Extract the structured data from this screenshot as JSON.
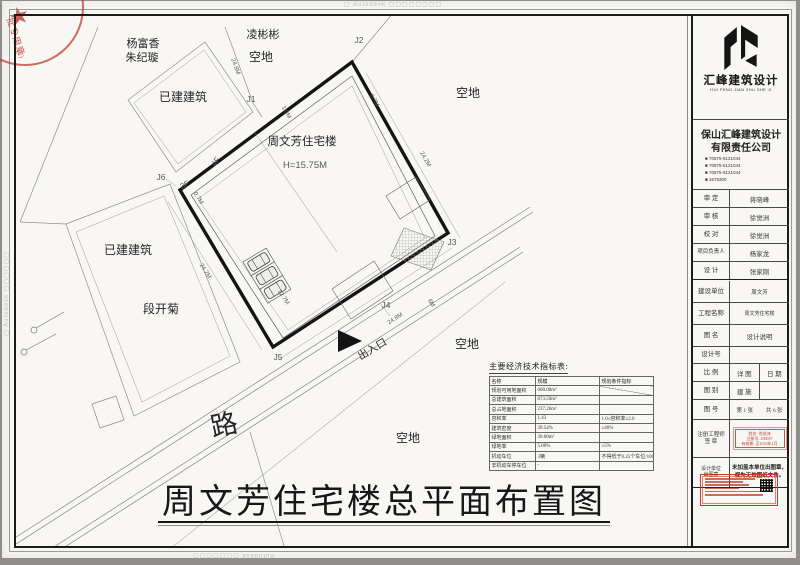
{
  "watermarks": {
    "top": "▢ Autodesk ▢▢▢▢▢▢▢▢",
    "left": "▢ Autodesk ▢▢▢▢▢▢",
    "right": "▢ Autodesk ▢▢▢▢▢▢",
    "bottom": "Autodesk ▢▢▢▢▢▢▢"
  },
  "corner_stamp": {
    "star": "★",
    "line1": "批专用章",
    "line2": "(2)"
  },
  "plan": {
    "labels": {
      "building": "周文芳住宅楼",
      "height": "H=15.75M",
      "neighbor_n": "凌彬彬",
      "vacant_n": "空地",
      "owner_nw1": "杨富香",
      "owner_nw2": "朱纪璇",
      "existing_nw": "已建建筑",
      "vacant_e": "空地",
      "existing_w": "已建建筑",
      "owner_w": "段开菊",
      "vacant_s1": "空地",
      "vacant_s2": "空地",
      "road": "路",
      "entrance": "出入口",
      "floor4": "4F",
      "floor3": "3F"
    },
    "points": {
      "j1": "J1",
      "j2": "J2",
      "j3": "J3",
      "j4": "J4",
      "j5": "J5",
      "j6": "J6"
    },
    "dims": {
      "nw_edge": "24.8M",
      "top_inset": "1.0M",
      "ne_inset": "0.7M",
      "east_edge": "24.2M",
      "west_edge": "24.2M",
      "west_inset": "0.7M",
      "parking": "12.7M",
      "south_edge": "24.8M",
      "south_inset": "6M"
    }
  },
  "indicator_table": {
    "title": "主要经济技术指标表:",
    "rows": [
      [
        "名称",
        "规模",
        "规划条件指标"
      ],
      [
        "规划可用地面积",
        "600.00m²",
        ""
      ],
      [
        "总建筑面积",
        "873.59m²",
        ""
      ],
      [
        "总占地面积",
        "237.26m²",
        ""
      ],
      [
        "容积率",
        "1.43",
        "1.0≤容积率≤2.0"
      ],
      [
        "建筑密度",
        "39.54%",
        "≤40%"
      ],
      [
        "绿地面积",
        "30.00m²",
        ""
      ],
      [
        "绿地率",
        "5.00%",
        "≥5%"
      ],
      [
        "机动车位",
        "3辆",
        "不得低于0.25个车位/100m²"
      ],
      [
        "非机动车停车位",
        "-",
        ""
      ]
    ]
  },
  "sheet_title": "周文芳住宅楼总平面布置图",
  "title_block": {
    "logo_name": "汇峰建筑设计",
    "logo_sub": "HUI FENG JIAN ZHU SHE JI",
    "company_line1": "保山汇峰建筑设计",
    "company_line2": "有限责任公司",
    "phones": [
      "■ 70875-6121044",
      "■ 70875-6121044",
      "■ 70875-6121044",
      "■ 1678300"
    ],
    "people": [
      {
        "label": "审 定",
        "value": "蒋晓峰"
      },
      {
        "label": "审 核",
        "value": "徐觉洲"
      },
      {
        "label": "校 对",
        "value": "徐觉洲"
      },
      {
        "label": "项目负责人",
        "value": "杨家龙"
      },
      {
        "label": "设 计",
        "value": "张家刚"
      }
    ],
    "info": [
      {
        "label": "建设单位",
        "value": "周文芳"
      },
      {
        "label": "工程名称",
        "value": "周文芳住宅楼"
      },
      {
        "label": "图 名",
        "value": "设计说明"
      },
      {
        "label": "设计号",
        "value": ""
      }
    ],
    "scale_row": {
      "label": "比 例",
      "c1": "详 图",
      "c2": "日 期"
    },
    "type_row": {
      "label": "图 别",
      "value": "建 施"
    },
    "no_row": {
      "label": "图 号",
      "v1": "第 1 张",
      "v2": "共 6 张"
    },
    "engineer_row": {
      "label1": "注册工程师",
      "label2": "签 章",
      "stamp": [
        "姓名: 徐觉洲",
        "注册号: 250037",
        "有效期: 至2016年1月"
      ]
    },
    "seal_row": {
      "label1": "设计单位",
      "label2": "出图章",
      "note1": "未加盖本单位出图章，",
      "note2": "视为无效图纸文件。"
    }
  }
}
